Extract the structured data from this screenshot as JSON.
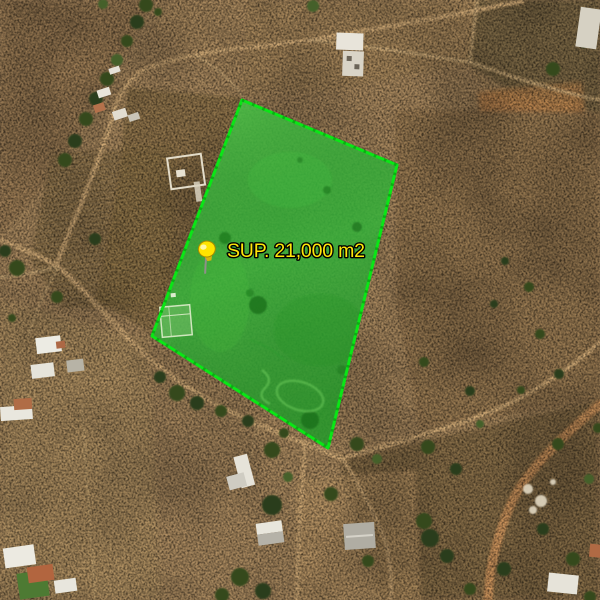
{
  "map": {
    "view_type": "satellite-imagery",
    "overlay": {
      "parcel": {
        "label": "SUP. 21,000 m2",
        "area_value": "21,000",
        "area_unit": "m2",
        "points": "242,100 397,165 328,448 152,336",
        "fill_color": "#35b33a",
        "border_color": "#0ae616"
      },
      "pin": {
        "icon": "pushpin-icon",
        "color": "#ffe400"
      },
      "label_style": {
        "color": "#ffe60a",
        "outline": "#000000"
      }
    }
  }
}
